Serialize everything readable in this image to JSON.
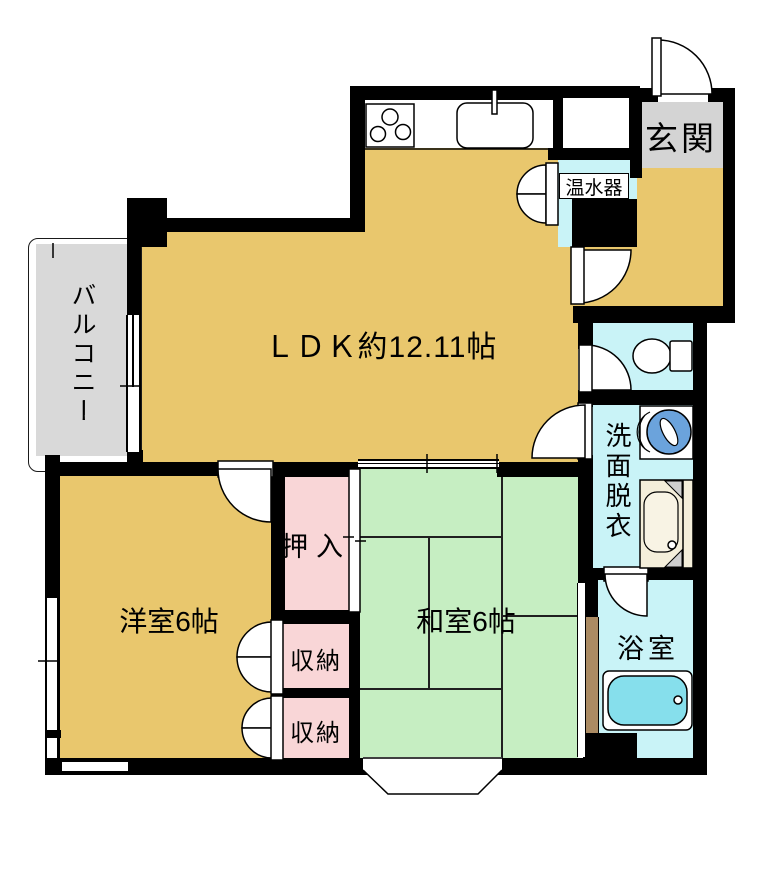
{
  "plan": {
    "type": "apartment-floor-plan",
    "rooms": {
      "ldk": {
        "label": "ＬＤＫ約12.11帖"
      },
      "entrance": {
        "label": "玄関"
      },
      "water_heater": {
        "label": "温水器"
      },
      "balcony": {
        "label": "バルコニー"
      },
      "washroom": {
        "label": "洗面脱衣"
      },
      "bathroom": {
        "label": "浴室"
      },
      "oshiire": {
        "label": "押入"
      },
      "storage_upper": {
        "label": "収納"
      },
      "storage_lower": {
        "label": "収納"
      },
      "western_room": {
        "label": "洋室6帖"
      },
      "japanese_room": {
        "label": "和室6帖"
      }
    },
    "colors": {
      "wall": "#000000",
      "ldk_floor": "#e9c76d",
      "tatami_green": "#c6eec2",
      "closet_pink": "#f9d6d7",
      "water_area_cyan": "#c9f3f7",
      "entrance_gray": "#d4d4d4",
      "balcony_gray": "#d9d9d9",
      "bathtub_blue": "#86dfec",
      "washer_blue": "#6ba3dc",
      "wood_brown": "#ab8b63",
      "vanity_cream": "#f4eeda"
    },
    "fixtures": [
      "gas-stove",
      "kitchen-sink",
      "water-heater-cabinet",
      "toilet",
      "washing-machine",
      "vanity-sink",
      "bathtub",
      "bay-window"
    ]
  }
}
